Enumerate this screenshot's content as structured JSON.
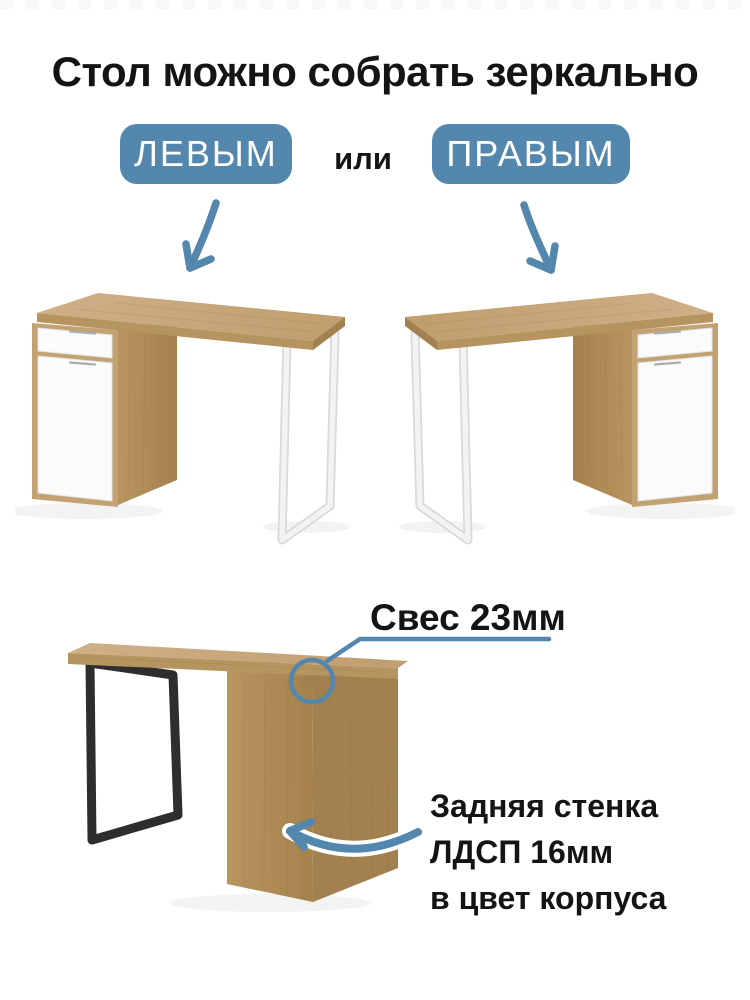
{
  "colors": {
    "accent_blue": "#5487ad",
    "text_dark": "#141414",
    "badge_text": "#ffffff",
    "wood_light": "#cbab80",
    "wood_mid": "#b6945f",
    "wood_dark": "#a2804f",
    "wood_frame": "#c2a173",
    "panel_white": "#fbfbfb",
    "leg_black": "#2e2e2e"
  },
  "header": {
    "title": "Стол можно собрать зеркально"
  },
  "options": {
    "left_label": "ЛЕВЫМ",
    "separator": "или",
    "right_label": "ПРАВЫМ"
  },
  "callouts": {
    "overhang_label": "Свес 23мм",
    "back_panel_line1": "Задняя стенка",
    "back_panel_line2": "ЛДСП 16мм",
    "back_panel_line3": "в цвет корпуса"
  }
}
